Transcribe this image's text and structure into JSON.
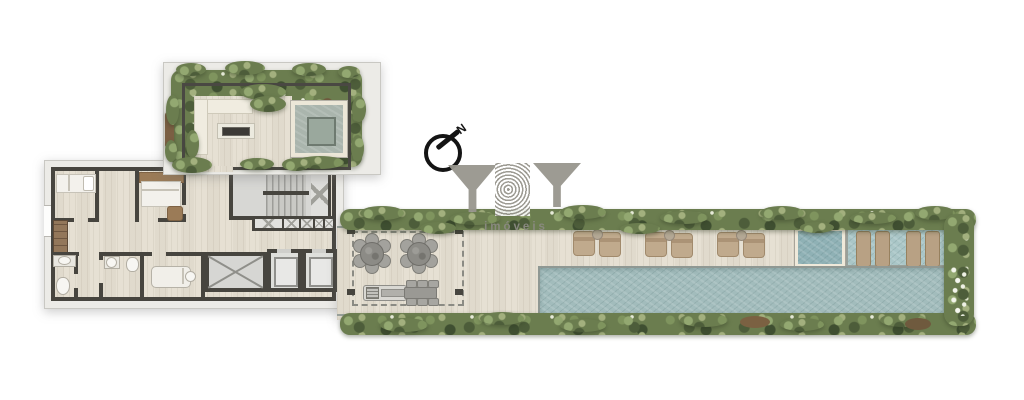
{
  "compass": {
    "north_label": "N"
  },
  "watermark": {
    "brand": "YBY",
    "tagline": "imóveis"
  },
  "palette": {
    "background": "#ffffff",
    "walls": "#47453f",
    "deck": "#e6e0d3",
    "foliage": "#6b7d4f",
    "pool_water": "#a2bcbc",
    "spa_water": "#8fb1b5",
    "outer_band": "#ecebe7",
    "furniture_tan": "#c0aa8d",
    "logo_gray": "#98968e"
  },
  "inventory": {
    "bedrooms": 2,
    "bathrooms": 2,
    "massage_tables": 1,
    "elevators": 2,
    "stairwells": 1,
    "round_tables": 2,
    "chairs_per_round_table": 6,
    "bbq_grills": 1,
    "dining_tables": 1,
    "deck_lounge_chair_pairs": 3,
    "in_pool_loungers": 4,
    "spas": 1,
    "lap_pools": 1,
    "fire_pits": 1,
    "garden_water_features": 1,
    "l_shaped_benches": 1
  }
}
